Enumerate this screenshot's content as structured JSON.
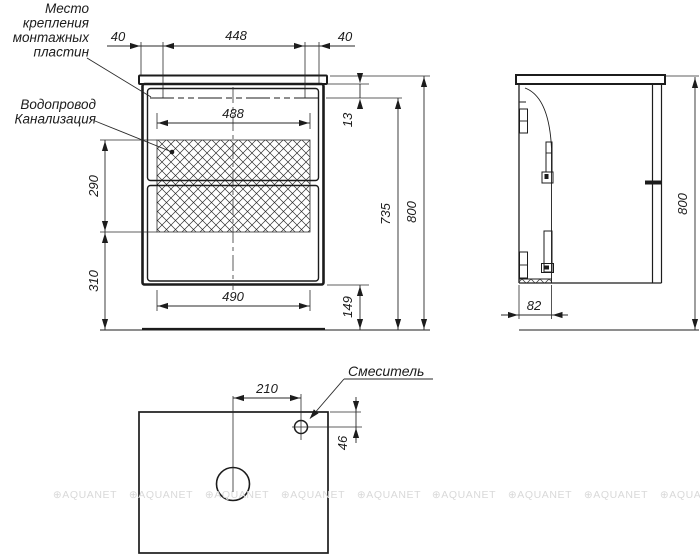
{
  "drawing": {
    "title_context": "bathroom vanity cabinet installation drawing",
    "labels": {
      "mounting_lines": [
        "Место",
        "крепления",
        "монтажных",
        "пластин"
      ],
      "plumbing_lines": [
        "Водопровод",
        "Канализация"
      ],
      "faucet": "Смеситель"
    },
    "front": {
      "dims": {
        "offset_left": "40",
        "plate_span": "448",
        "offset_right": "40",
        "inner_width": "488",
        "plate_drop": "13",
        "plate_to_floor": "735",
        "total_height": "800",
        "hatch_zone_height": "290",
        "lower_zone_height": "310",
        "drawer_inner_width": "490",
        "bottom_clearance": "149"
      }
    },
    "side": {
      "dims": {
        "back_zone_depth": "82",
        "total_height": "800"
      }
    },
    "top": {
      "dims": {
        "faucet_offset_from_center": "210",
        "faucet_offset_from_back": "46"
      }
    },
    "watermark": {
      "text": "⊕AQUANET",
      "color": "#d9d9d9"
    },
    "colors": {
      "line": "#1c1c1c",
      "dimension": "#2a2a2a",
      "background": "#ffffff"
    }
  }
}
